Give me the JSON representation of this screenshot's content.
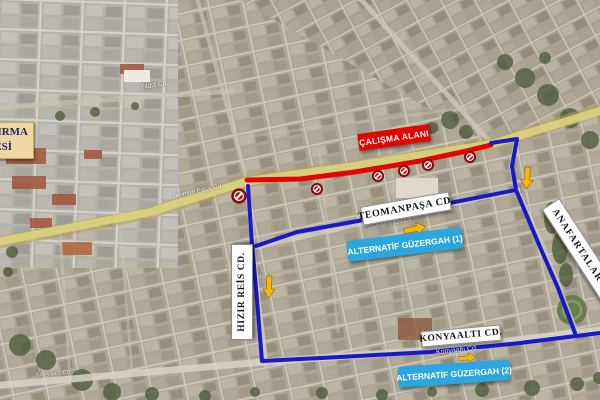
{
  "annotations": {
    "work_area": {
      "label": "ÇALIŞMA ALANI",
      "bg_color": "#e10600",
      "text_color": "#ffffff"
    },
    "street_teomanpasa": {
      "label": "TEOMANPAŞA CD.",
      "bg_color": "#ffffff",
      "text_color": "#141414"
    },
    "alt_route_1": {
      "label": "ALTERNATİF GÜZERGAH (1)",
      "bg_color": "#2aa7df",
      "text_color": "#ffffff"
    },
    "street_konyaalti": {
      "label": "KONYAALTI CD.",
      "bg_color": "#ffffff",
      "text_color": "#141414"
    },
    "alt_route_2": {
      "label": "ALTERNATİF GÜZERGAH (2)",
      "bg_color": "#2aa7df",
      "text_color": "#ffffff"
    },
    "street_hizir_reis": {
      "label": "HIZIR REİS CD.",
      "bg_color": "#ffffff",
      "text_color": "#141414"
    },
    "street_anafartalar": {
      "label": "ANAFARTALAR CD. (GÜLL",
      "bg_color": "#ffffff",
      "text_color": "#141414"
    },
    "hospital_fragment": {
      "line1": "TIRMA",
      "line2": "ESİ",
      "bg_color": "#efd6a2",
      "text_color": "#1e2a66"
    }
  },
  "base_map_road_names": {
    "yildiz": "Yıldız Cd.",
    "teoman_on_main_road": "Teoman Paşa Cd",
    "teoman_on_street": "Teoman Paşa Cd.",
    "hizir_on_street": "Hızır Reis Cd",
    "konyaalti_on_street": "Konyaaltı Cd.",
    "konyaalti_bottom_left": "Konyaaltı Cd."
  },
  "map_graphics": {
    "closed_section_color": "#e10600",
    "alternative_route_color": "#1a18c8",
    "direction_arrow_color": "#f6b70a",
    "roadwork_marker_color": "#a50f0f",
    "roadwork_marker_count": 6,
    "highlighted_road_color": "#ddd27d"
  }
}
